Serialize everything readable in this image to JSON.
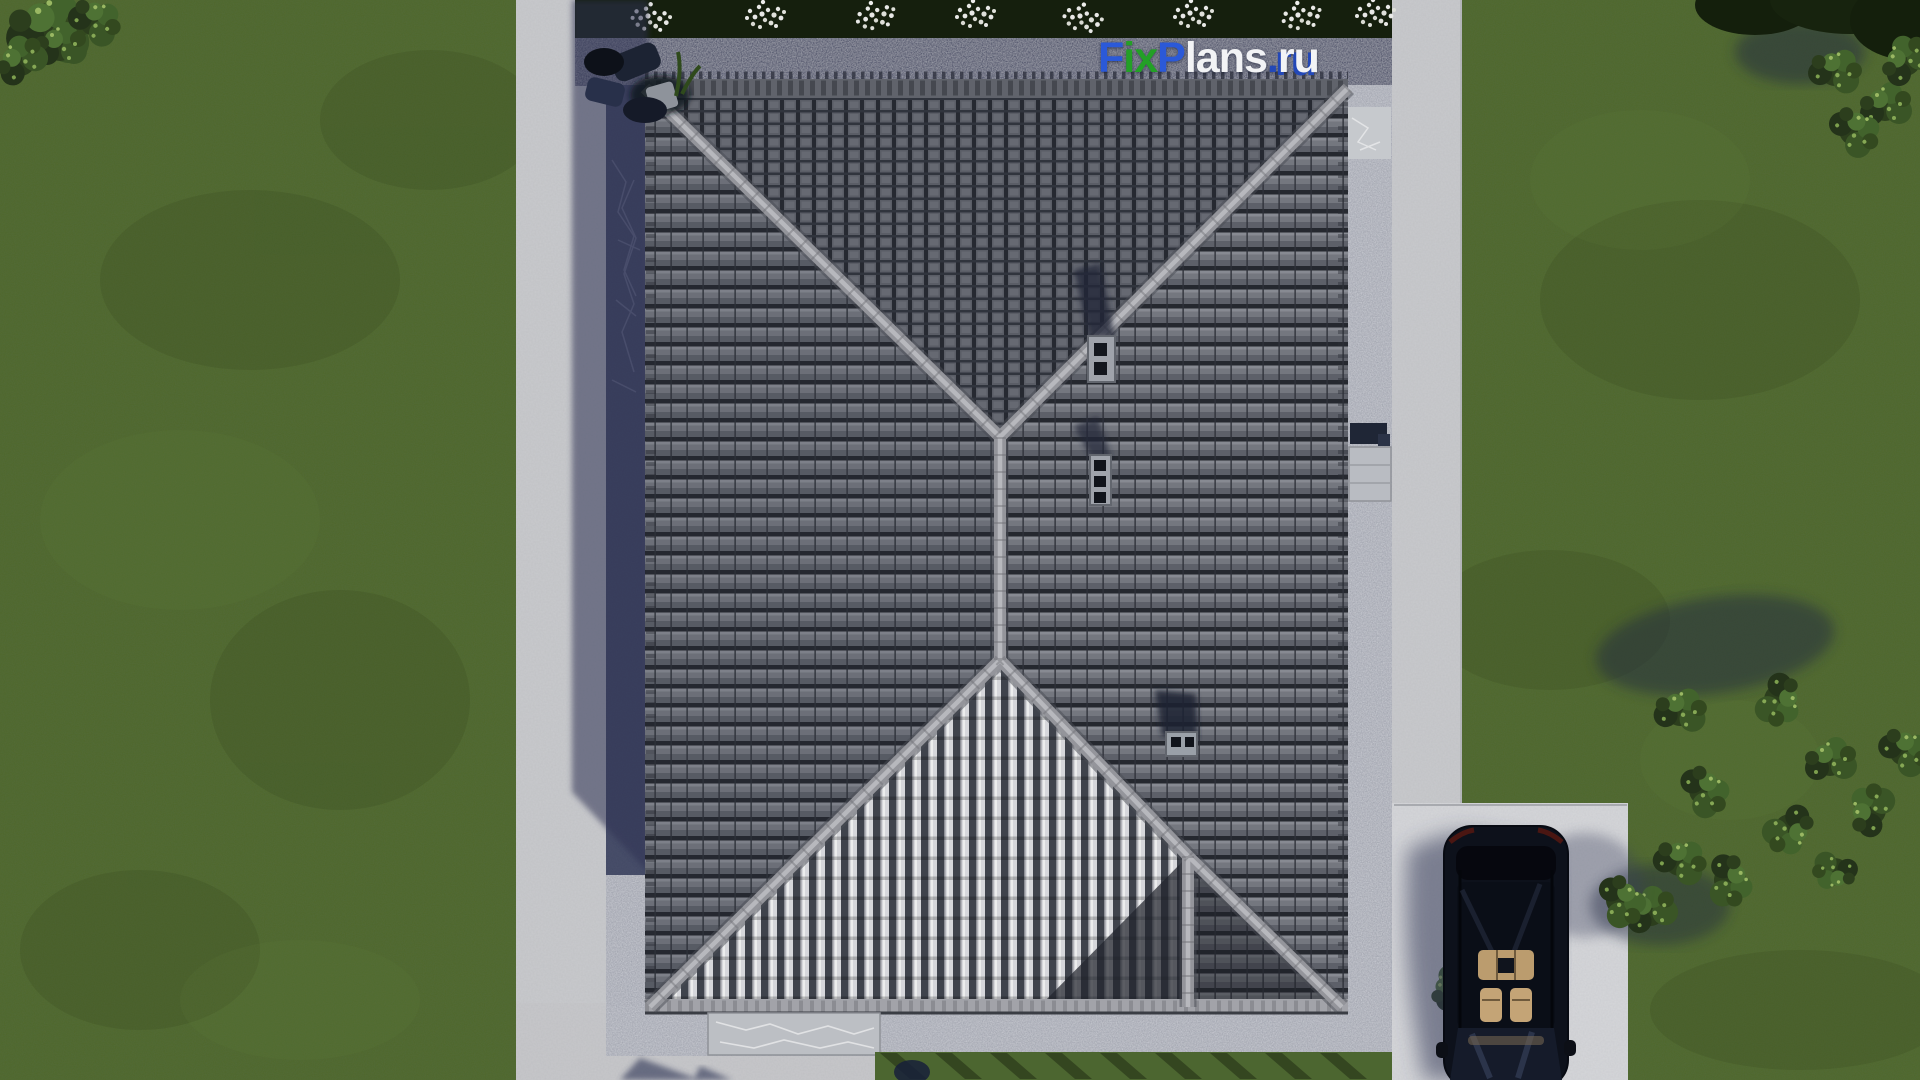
{
  "watermark": {
    "name": "FixPlans.ru",
    "segments": [
      {
        "text": "F",
        "color": "#2b59d8"
      },
      {
        "text": "ix",
        "color": "#23a026"
      },
      {
        "text": "P",
        "color": "#2b59d8"
      },
      {
        "text": "lans",
        "color": "#f2f3f5"
      },
      {
        "text": ".",
        "color": "#2348b8"
      },
      {
        "text": "ru",
        "color": "#f2f3f5"
      }
    ]
  },
  "scene": {
    "description": "Aerial top-down 3D architectural render of a house with a gray hipped tile roof, surrounded by concrete walkways and gravel strips, green lawn with shrubs, flower bed along the top, and a black car parked on a driveway pad at bottom right",
    "objects": {
      "roof": "gray hipped tile roof with ridge caps and three chimneys",
      "lawn": "green grass lawn",
      "flower_bed": "dark planting bed with white flower clusters",
      "car": "black car with glass roof showing beige interior",
      "driveway": "light concrete driveway pad",
      "bushes": "dark green shrubs on right side and corners",
      "walkways": "light concrete paths with gravel drip strips",
      "patio_furniture": "dark patio objects at top-left corner of house"
    },
    "palette": {
      "grass": "#50682e",
      "grass_dark": "#3f5526",
      "concrete": "#c9cacd",
      "driveway": "#d4d5d8",
      "gravel_light": "#b4b7bf",
      "gravel_shadow": "#474b63",
      "roof_tile_gray": "#71747c",
      "roof_course_dark": "#272a31",
      "roof_bright_rib": "#d7d8dc",
      "ridge_cap": "#94959b",
      "cast_shadow": "#2f3454",
      "car_body": "#0d111b",
      "car_interior_beige": "#c4a476",
      "bed_green": "#1a2611",
      "bush_green": "#3a5526",
      "flower_white": "#e8e8e6"
    }
  }
}
